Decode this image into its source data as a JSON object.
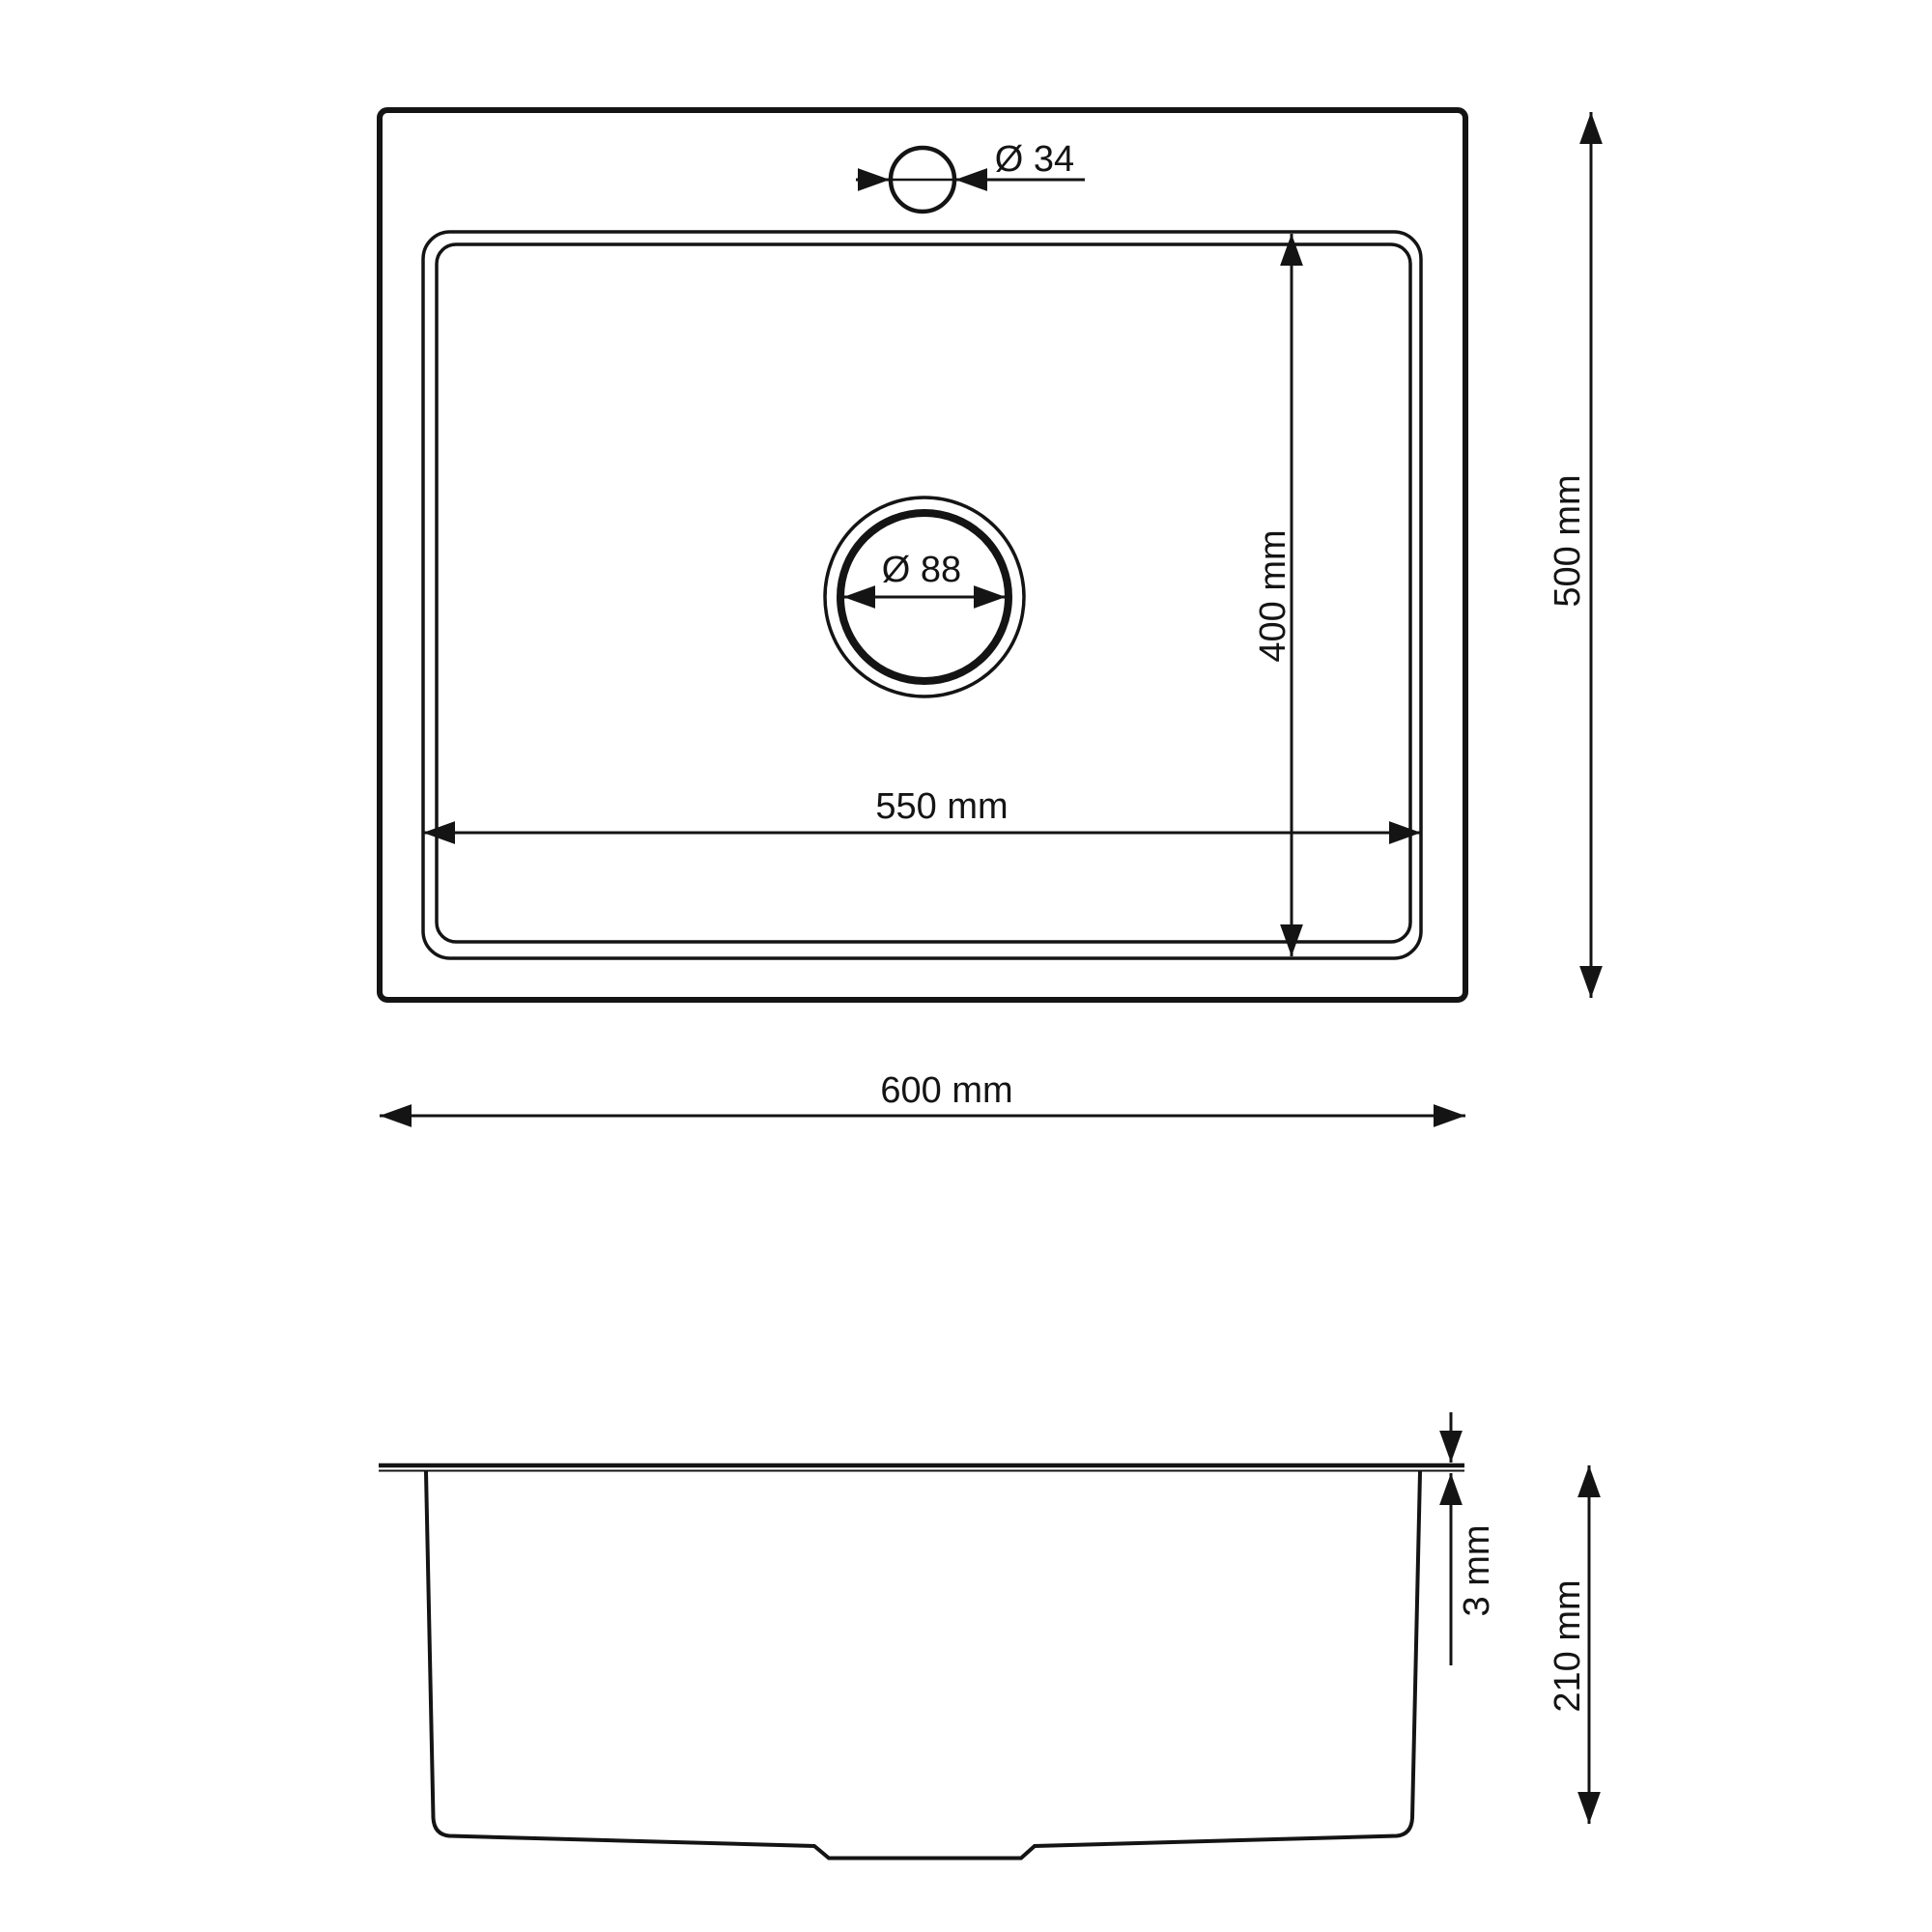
{
  "page": {
    "background_color": "#ffffff",
    "line_color": "#141414"
  },
  "drawing": {
    "kind": "technical dimensional drawing",
    "subject": "single-bowl kitchen sink, top view and side section view",
    "views": [
      {
        "name": "top-view",
        "description": "plan view of sink with faucet hole, bowl and drain"
      },
      {
        "name": "side-view",
        "description": "front section profile of bowl with rim"
      }
    ]
  },
  "dimensions": {
    "faucet_hole_diameter": {
      "label": "Ø 34",
      "value_mm": 34
    },
    "drain_diameter": {
      "label": "Ø 88",
      "value_mm": 88
    },
    "bowl_width": {
      "label": "550 mm",
      "value_mm": 550
    },
    "bowl_depth": {
      "label": "400 mm",
      "value_mm": 400
    },
    "overall_width": {
      "label": "600 mm",
      "value_mm": 600
    },
    "overall_depth": {
      "label": "500 mm",
      "value_mm": 500
    },
    "rim_thickness": {
      "label": "3 mm",
      "value_mm": 3
    },
    "bowl_height": {
      "label": "210 mm",
      "value_mm": 210
    }
  }
}
